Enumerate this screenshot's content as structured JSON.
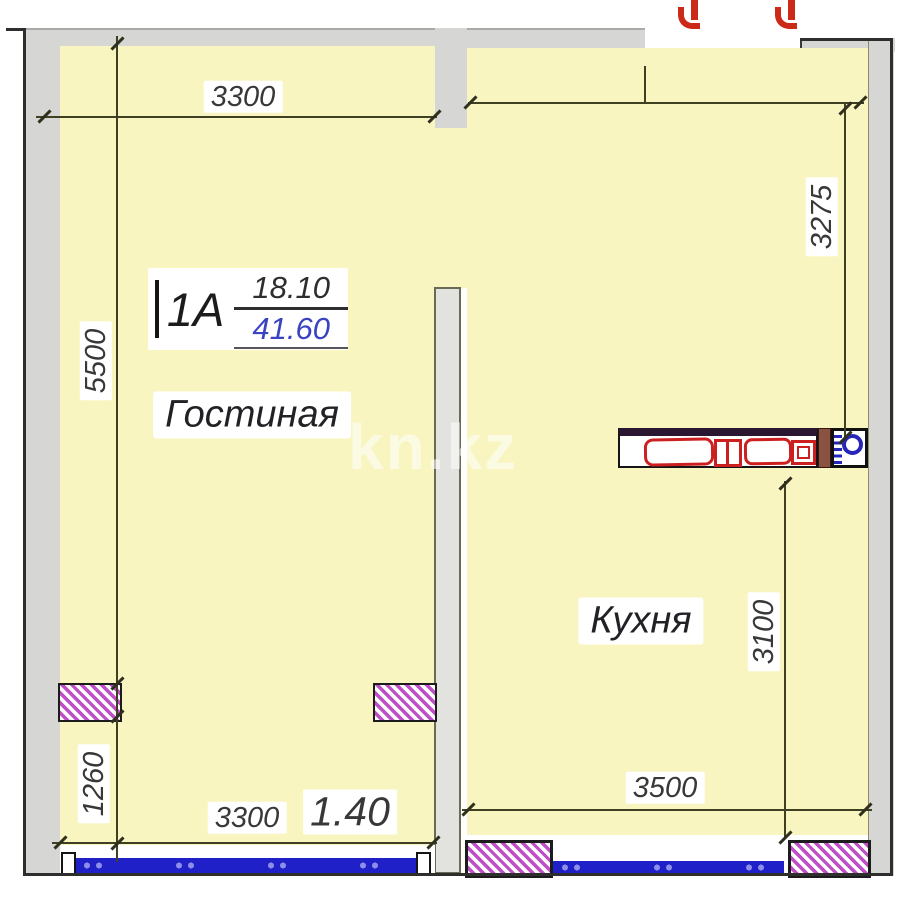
{
  "watermark": "kn.kz",
  "apartment": {
    "type": "1A",
    "room_area": "18.10",
    "total_area": "41.60"
  },
  "rooms": {
    "living": "Гостиная",
    "kitchen": "Кухня"
  },
  "dims": {
    "living_width_top": "3300",
    "living_height": "5500",
    "living_lower_height": "1260",
    "living_width_bottom": "3300",
    "living_bottom_extra": "1.40",
    "kitchen_height_upper": "3275",
    "kitchen_height_lower": "3100",
    "kitchen_width_bottom": "3500"
  },
  "colors": {
    "room_fill": "#f8f5c1",
    "wall_fill": "#d6d6d4",
    "outline": "#2e2e2c",
    "dimension_line": "#3f3f22",
    "window_blue": "#2020c8",
    "vent_hatch_magenta": "#bf4fc6",
    "appliance_red": "#cc2020",
    "total_area_blue": "#3a44c0",
    "door_marker_red": "#cc2a18",
    "counter_wood_brown": "#8a5240",
    "burner_blue": "#2626b8"
  }
}
